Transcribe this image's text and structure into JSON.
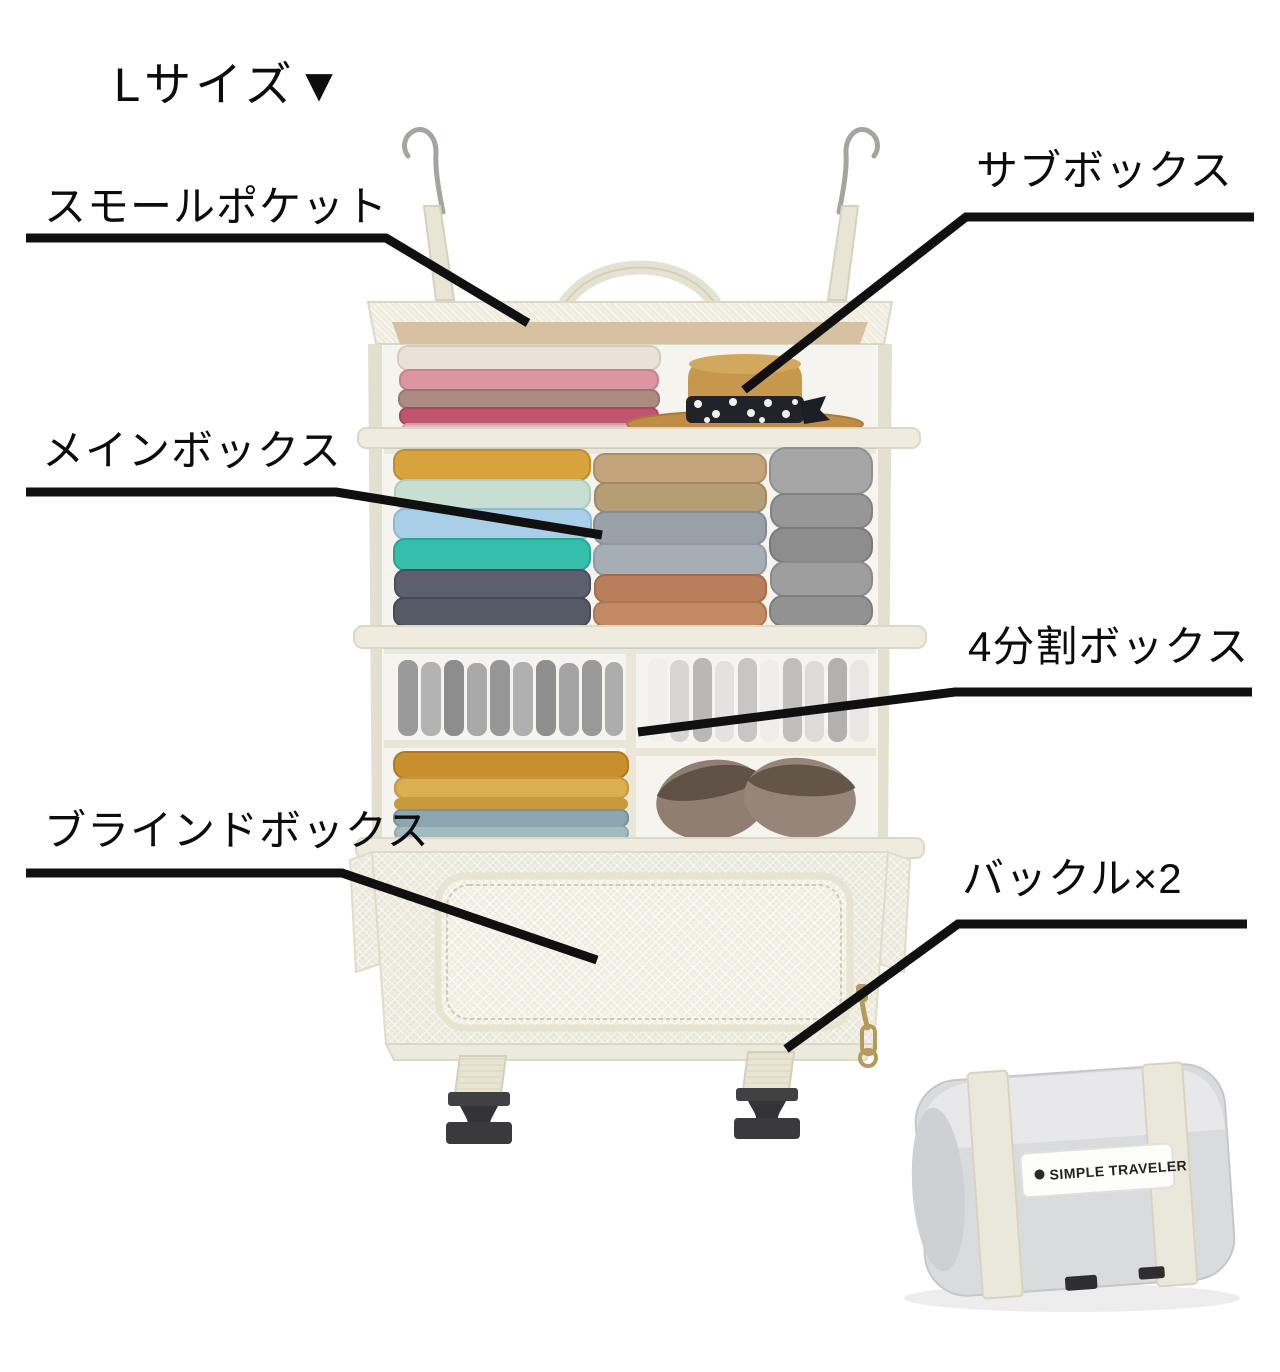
{
  "title": {
    "size_label": "Lサイズ▼"
  },
  "callouts": [
    {
      "id": "small-pocket",
      "label": "スモールポケット"
    },
    {
      "id": "sub-box",
      "label": "サブボックス"
    },
    {
      "id": "main-box",
      "label": "メインボックス"
    },
    {
      "id": "quad-box",
      "label": "4分割ボックス"
    },
    {
      "id": "blind-box",
      "label": "ブラインドボックス"
    },
    {
      "id": "buckle-x2",
      "label": "バックル×2"
    }
  ],
  "product": {
    "brand_label": "SIMPLE TRAVELER",
    "colors": {
      "fabric_cream": "#edeadd",
      "mesh_white": "#f5f4ee",
      "inner_tan": "#d8c1a0",
      "hat_straw": "#c6984d",
      "hat_band_black": "#22222a",
      "buckle_black": "#3a3a3c",
      "zipper_gold": "#b59a5a",
      "annotation_black": "#101010"
    }
  }
}
